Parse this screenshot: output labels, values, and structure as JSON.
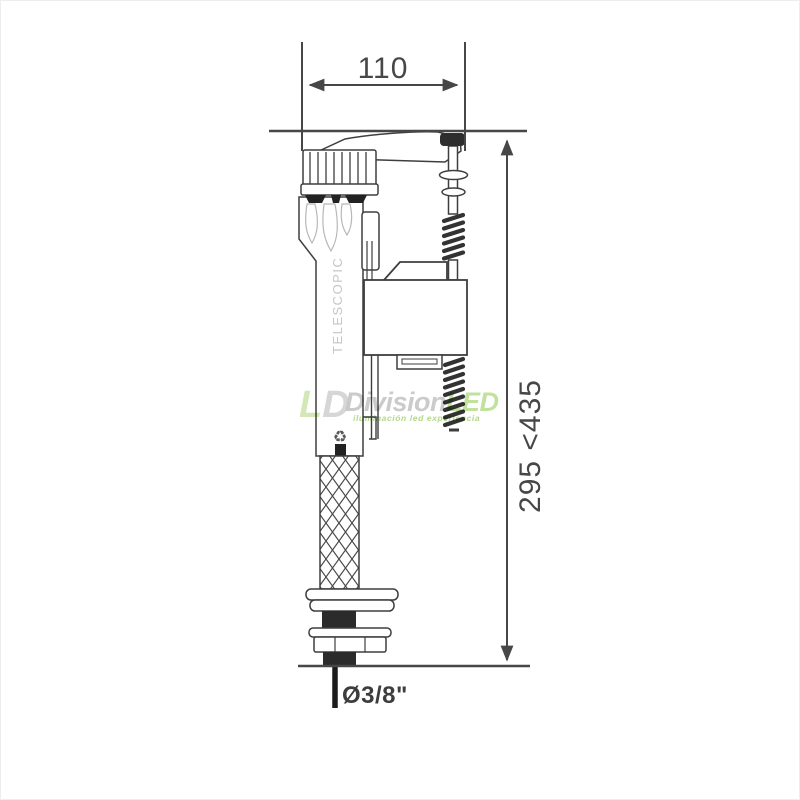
{
  "diagram": {
    "dimensions": {
      "width": "110",
      "height_range": "295 <435",
      "inlet_diameter": "Ø3/8\""
    },
    "valve": {
      "body_text": "TELESCOPIC",
      "recycle_icon": "♻"
    },
    "watermark": {
      "logo_l": "L",
      "logo_d": "D",
      "brand_gray": "Division",
      "brand_green": "LED",
      "tagline": "iluminación led experiencia"
    },
    "colors": {
      "line": "#3e3e3e",
      "dimension_text": "#474747",
      "watermark_gray": "#c2c2c2",
      "watermark_green": "#b7dc8d",
      "tagline_green": "#9ed06c"
    }
  }
}
